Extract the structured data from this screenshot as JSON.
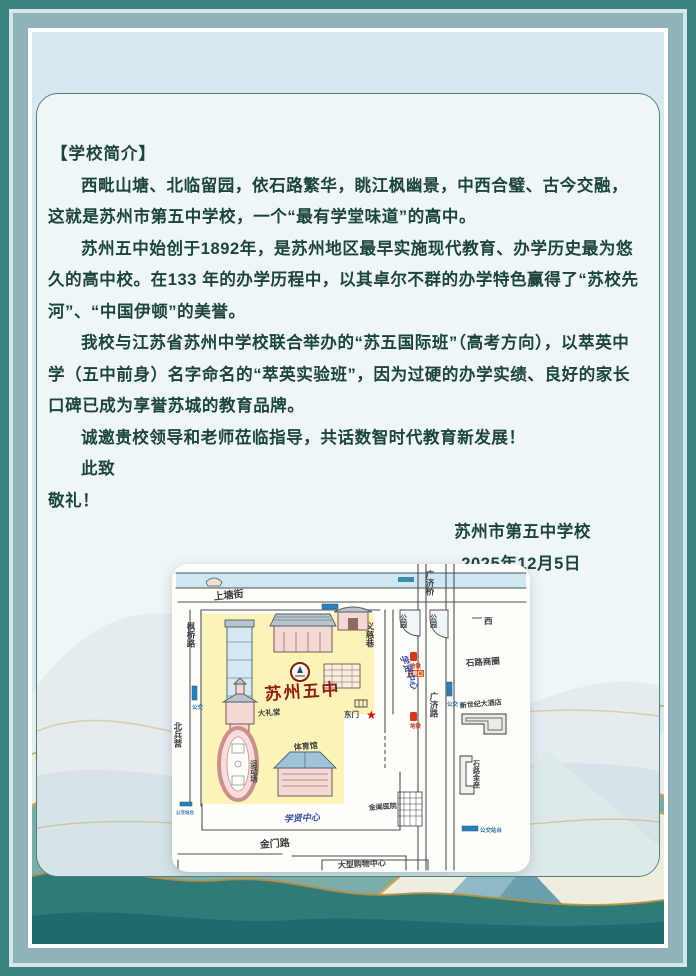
{
  "letter": {
    "section_title": "【学校简介】",
    "paragraphs": [
      "西毗山塘、北临留园，依石路繁华，眺江枫幽景，中西合璧、古今交融，这就是苏州市第五中学校，一个“最有学堂味道”的高中。",
      "苏州五中始创于1892年，是苏州地区最早实施现代教育、办学历史最为悠久的高中校。在133 年的办学历程中，以其卓尔不群的办学特色赢得了“苏校先河”、“中国伊顿”的美誉。",
      "我校与江苏省苏州中学校联合举办的“苏五国际班”（高考方向），以萃英中学（五中前身）名字命名的“萃英实验班”，因为过硬的办学实绩、良好的家长口碑已成为享誉苏城的教育品牌。",
      "诚邀贵校领导和老师莅临指导，共话数智时代教育新发展！"
    ],
    "closing": "此致",
    "salute": "敬礼！",
    "signature": "苏州市第五中学校",
    "date": "2025年12月5日"
  },
  "map": {
    "school_name": "苏州五中",
    "labels": {
      "shangtang_street": "上塘街",
      "guangji_bridge": "广济桥",
      "guangji_road": "广济路",
      "yici_lane": "义慈巷",
      "park1": "公园",
      "park2": "公园",
      "west": "西",
      "shilu_district": "石路商圈",
      "hotel": "新世纪大酒店",
      "jinzuo": "石路金座",
      "hospital": "金阊医院",
      "bus_station": "公交站台",
      "bus": "公交",
      "metro": "地铁",
      "metro_exit": "1号口",
      "fengqiao_road": "枫桥路",
      "beibingying": "北兵营",
      "auditorium": "大礼堂",
      "gym": "体育馆",
      "track": "运动场",
      "east_gate": "东门",
      "xuexian_center": "学贤中心",
      "xuexian_center2": "学贤中心",
      "jinmen_road": "金门路",
      "mall": "大型购物中心",
      "star": "★"
    }
  },
  "colors": {
    "frame_dark_teal": "#3a8181",
    "frame_mid": "#8fb2b6",
    "card_bg": "#eef6f8",
    "text_green": "#1c443b",
    "campus_yellow": "#fbf0a8",
    "school_red": "#8f1d15",
    "gold": "#c9a355"
  }
}
